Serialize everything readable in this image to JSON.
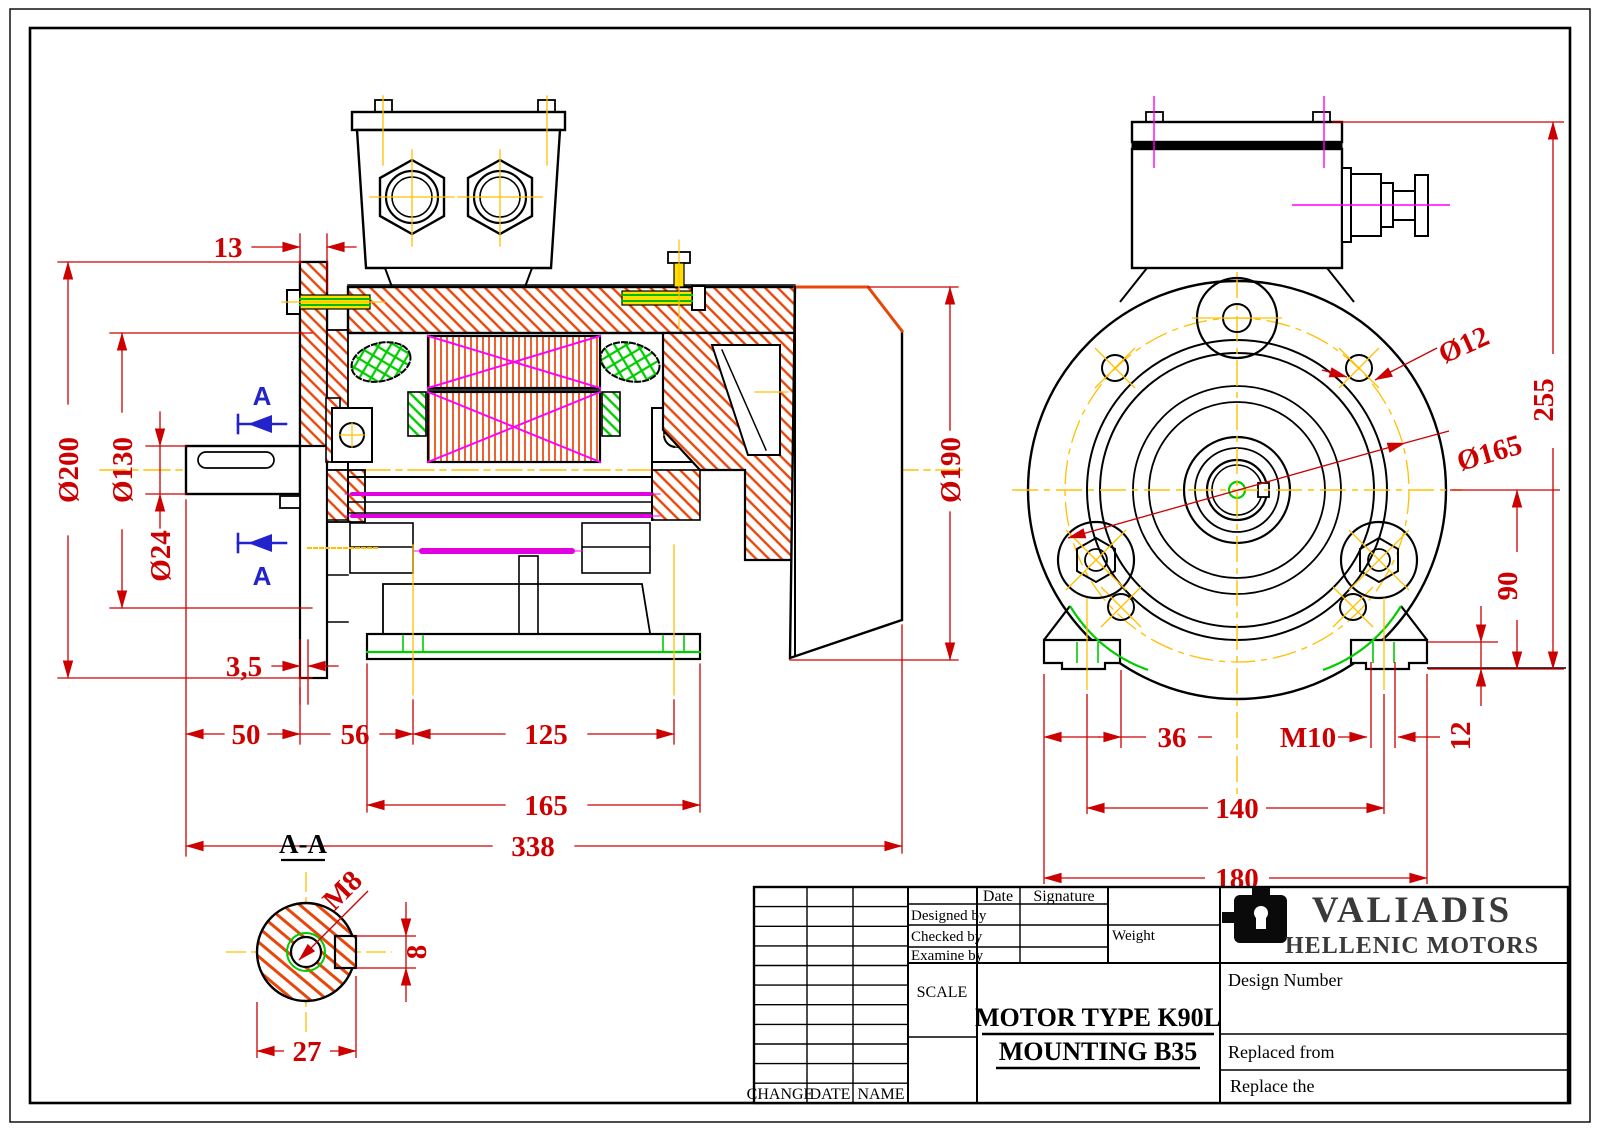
{
  "drawing_title": {
    "motor_type": "MOTOR TYPE K90L",
    "mounting": "MOUNTING   B35"
  },
  "company": {
    "name": "VALIADIS",
    "subtitle": "HELLENIC MOTORS"
  },
  "title_block": {
    "date": "Date",
    "signature": "Signature",
    "designed_by": "Designed by",
    "checked_by": "Checked by",
    "examine_by": "Examine by",
    "weight": "Weight",
    "scale": "SCALE",
    "change": "CHANGE",
    "date_col": "DATE",
    "name_col": "NAME",
    "design_number": "Design Number",
    "replaced_from": "Replaced from",
    "replace_the": "Replace the"
  },
  "section": {
    "label": "A-A",
    "cut_arrow": "A",
    "thread": "M8",
    "key_height": "8",
    "key_width": "27"
  },
  "dimensions_side": {
    "box_offset": "13",
    "flange_od": "Ø200",
    "spigot_od": "Ø130",
    "shaft_od": "Ø24",
    "flange_gap": "3,5",
    "shaft_len": "50",
    "flange_to_foot": "56",
    "foot_spacing": "125",
    "base_len": "165",
    "total_len": "338",
    "fan_od": "Ø190"
  },
  "dimensions_front": {
    "flange_hole": "Ø12",
    "bolt_circle": "Ø165",
    "total_height": "255",
    "shaft_height": "90",
    "foot_thickness": "12",
    "foot_edge": "36",
    "foot_thread": "M10",
    "foot_cc": "140",
    "foot_width": "180"
  },
  "colors": {
    "dimension": "#cc0000",
    "centerline": "#ffc000",
    "hatch": "#e8470b",
    "winding_x": "#ff00ff",
    "thread_green": "#00cc00",
    "section_arrow": "#2323cc",
    "company_text": "#3a3a3a"
  }
}
